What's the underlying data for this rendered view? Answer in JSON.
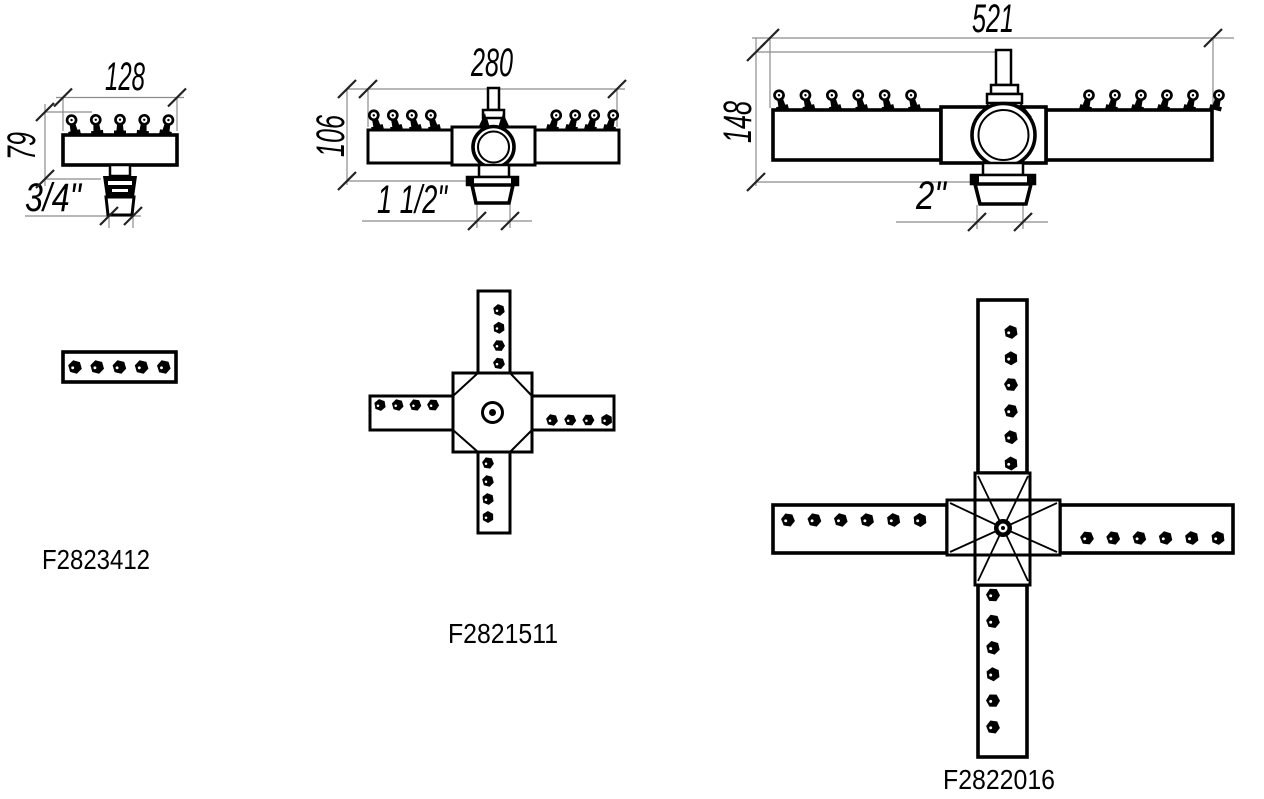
{
  "sheet": {
    "background": "#ffffff",
    "line_color": "#000000",
    "dimension_line_color": "#8c8c8c"
  },
  "drawings": [
    {
      "part_number": "F2823412",
      "shape": "single-bar",
      "dimensions": {
        "width": "128",
        "height": "79",
        "thread": "3/4\""
      },
      "front_nozzle_count": 5,
      "plan_nozzle_count": 5
    },
    {
      "part_number": "F2821511",
      "shape": "four-arm-cross",
      "dimensions": {
        "width": "280",
        "height": "106",
        "thread": "1 1/2\""
      },
      "front_nozzles_per_arm": 4,
      "plan_nozzles_per_arm": 4,
      "plan_arm_count": 4
    },
    {
      "part_number": "F2822016",
      "shape": "four-arm-cross",
      "dimensions": {
        "width": "521",
        "height": "148",
        "thread": "2\""
      },
      "front_nozzles_per_arm": 6,
      "plan_nozzles_per_arm": 6,
      "plan_arm_count": 4
    }
  ]
}
